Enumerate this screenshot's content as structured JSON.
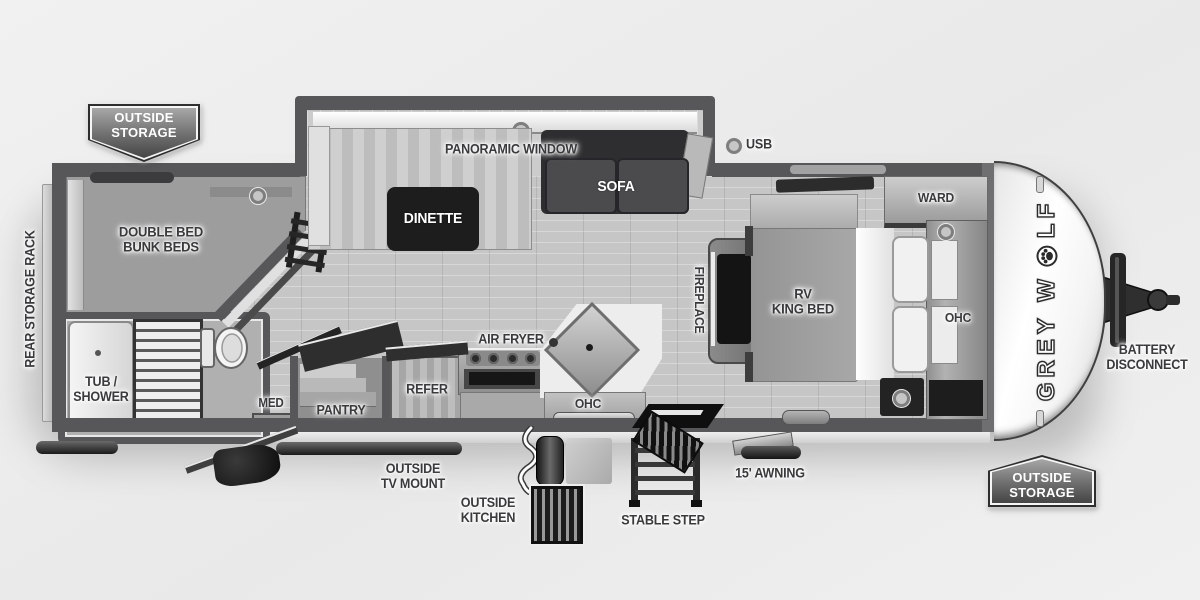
{
  "meta": {
    "title": "Grey Wolf travel trailer floor plan"
  },
  "colors": {
    "wall": "#57575a",
    "floor": "#c6c6c6",
    "label_text": "#3a3a3c",
    "dinette_table": "#1d1d1d",
    "sofa": "#47474a",
    "front_cap": "#ffffff",
    "badge_gradient_top": "#a7a7a7",
    "badge_gradient_bottom": "#454545"
  },
  "badge": {
    "line1": "OUTSIDE",
    "line2": "STORAGE"
  },
  "brand": {
    "prefix": "GREY W",
    "suffix": "LF",
    "full": "GREY WOLF"
  },
  "labels": {
    "rear_storage_rack": "REAR STORAGE RACK",
    "bunk_line1": "DOUBLE BED",
    "bunk_line2": "BUNK BEDS",
    "panoramic_window": "PANORAMIC WINDOW",
    "dinette": "DINETTE",
    "sofa": "SOFA",
    "usb": "USB",
    "ward": "WARD",
    "king_line1": "RV",
    "king_line2": "KING BED",
    "ohc_bedroom": "OHC",
    "fireplace": "FIREPLACE",
    "air_fryer": "AIR FRYER",
    "tub_line1": "TUB /",
    "tub_line2": "SHOWER",
    "med": "MED",
    "pantry": "PANTRY",
    "refer": "REFER",
    "ohc_kitchen": "OHC",
    "tv_mount_line1": "OUTSIDE",
    "tv_mount_line2": "TV MOUNT",
    "outside_kitchen_line1": "OUTSIDE",
    "outside_kitchen_line2": "KITCHEN",
    "stable_step": "STABLE STEP",
    "awning": "15' AWNING",
    "battery_line1": "BATTERY",
    "battery_line2": "DISCONNECT"
  }
}
